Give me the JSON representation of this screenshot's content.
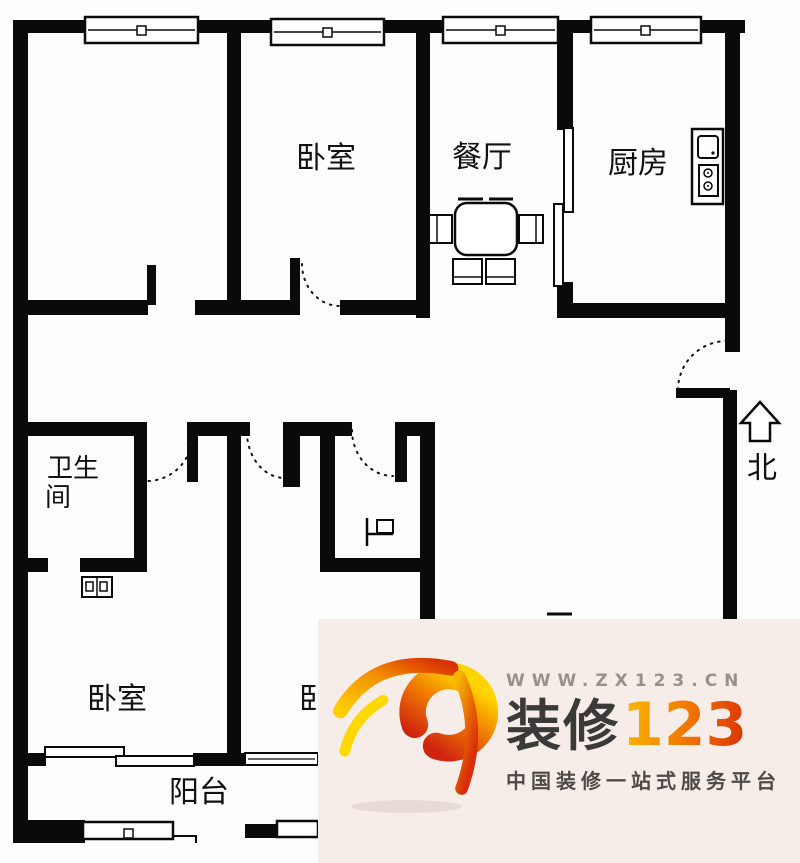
{
  "floor_plan": {
    "rooms": {
      "bedroom_top": {
        "label": "卧室"
      },
      "dining": {
        "label": "餐厅"
      },
      "kitchen": {
        "label": "厨房"
      },
      "bathroom": {
        "label_line1": "卫生",
        "label_line2": "间"
      },
      "bedroom_bottom_left": {
        "label": "卧室"
      },
      "bedroom_bottom_middle": {
        "label": "卧室"
      },
      "balcony": {
        "label": "阳台"
      }
    },
    "fixtures": {
      "dining_table": "dining-table-4-chairs",
      "kitchen_unit": "sink-and-2-burner-stove",
      "bath_basin": "washbasin",
      "small_room_fixture": "door-fixture-symbol"
    },
    "compass": {
      "label": "北"
    },
    "wall_color": "#0a0a0a"
  },
  "watermark": {
    "url": "WWW.ZX123.CN",
    "brand_text": "装修",
    "brand_number": "123",
    "tagline": "中国装修一站式服务平台",
    "panel_color": "#f6ede9",
    "brand_number_colors": [
      "#f9b000",
      "#ef7a00",
      "#dd3505"
    ],
    "logo_colors": [
      "#ffd400",
      "#f07c00",
      "#cf2410"
    ]
  }
}
